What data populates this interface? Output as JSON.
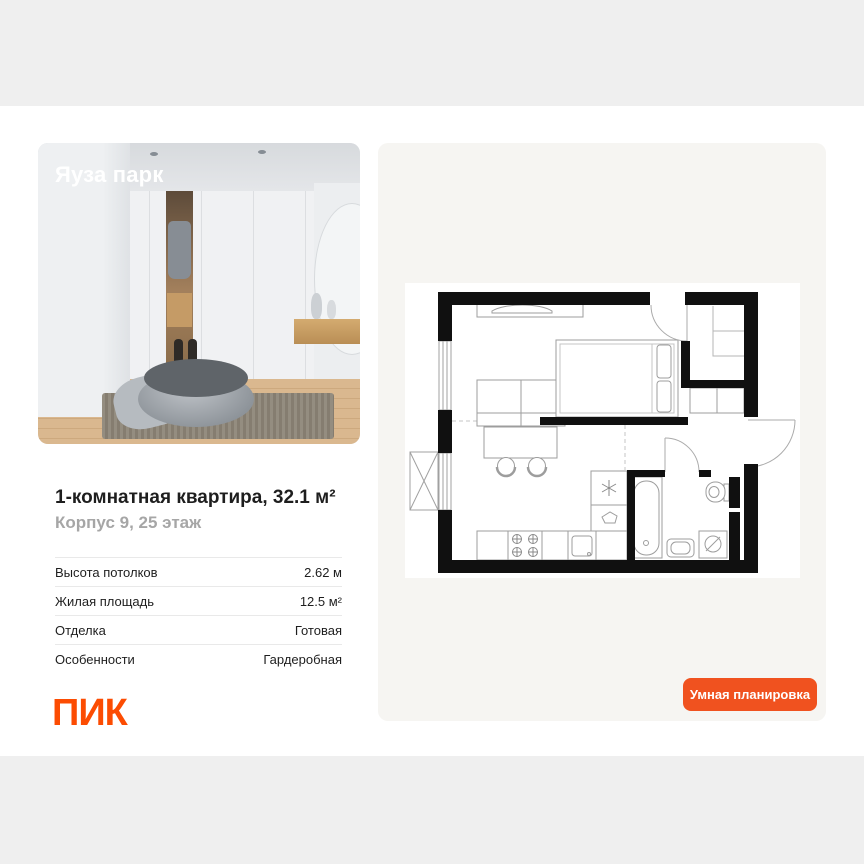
{
  "page": {
    "background": "#ffffff",
    "strip_color": "#efefef"
  },
  "photo_card": {
    "overlay_title": "Яуза парк"
  },
  "listing": {
    "title": "1-комнатная квартира, 32.1 м²",
    "subtitle": "Корпус 9, 25 этаж"
  },
  "params": {
    "rows": [
      {
        "label": "Высота потолков",
        "value": "2.62 м"
      },
      {
        "label": "Жилая площадь",
        "value": "12.5 м²"
      },
      {
        "label": "Отделка",
        "value": "Готовая"
      },
      {
        "label": "Особенности",
        "value": "Гардеробная"
      }
    ]
  },
  "developer": {
    "logo_text": "ПИК",
    "brand_color": "#fc4c02"
  },
  "floor_plan": {
    "button_label": "Умная планировка",
    "button_color": "#f0521f"
  }
}
